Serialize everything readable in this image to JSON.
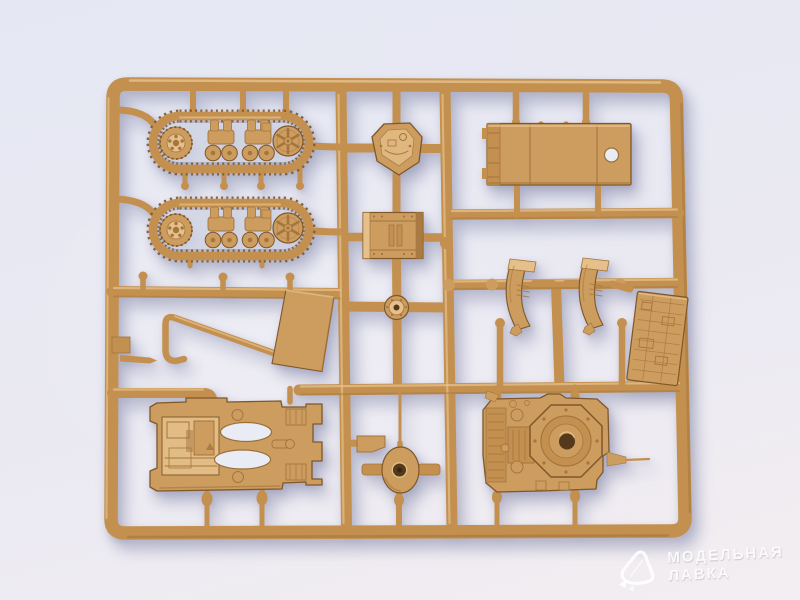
{
  "scene": {
    "type": "product photograph",
    "subject": "Tan injection-molded plastic model kit sprue with small-scale tank parts on a light studio background"
  },
  "sprue": {
    "parts": [
      "upper track assembly",
      "lower track assembly",
      "turret roof",
      "rear hull box",
      "road wheel",
      "tow bar",
      "side plate",
      "roof panel with hatch hole",
      "left fender",
      "right fender",
      "engine deck panel",
      "lower hull with openings",
      "gun mount with barrel",
      "upper hull with turret ring",
      "antenna"
    ]
  },
  "watermark": {
    "logo": "modelnaya-lavka-logo",
    "line1": "МОДЕЛЬНАЯ",
    "line2": "ЛАВКА"
  },
  "colors": {
    "background_top": "#e5e8f3",
    "background_mid": "#eae9f2",
    "background_bottom": "#f3eef1",
    "plastic": "#cd9d60",
    "plastic_hi": "#e5c08a",
    "plastic_mid": "#c3904f",
    "plastic_sh": "#a4753d",
    "plastic_dk": "#7f5728",
    "bg_hole": "#e9ecf5",
    "hole_dark": "#54391b",
    "watermark": "rgba(255,255,255,0.88)"
  }
}
